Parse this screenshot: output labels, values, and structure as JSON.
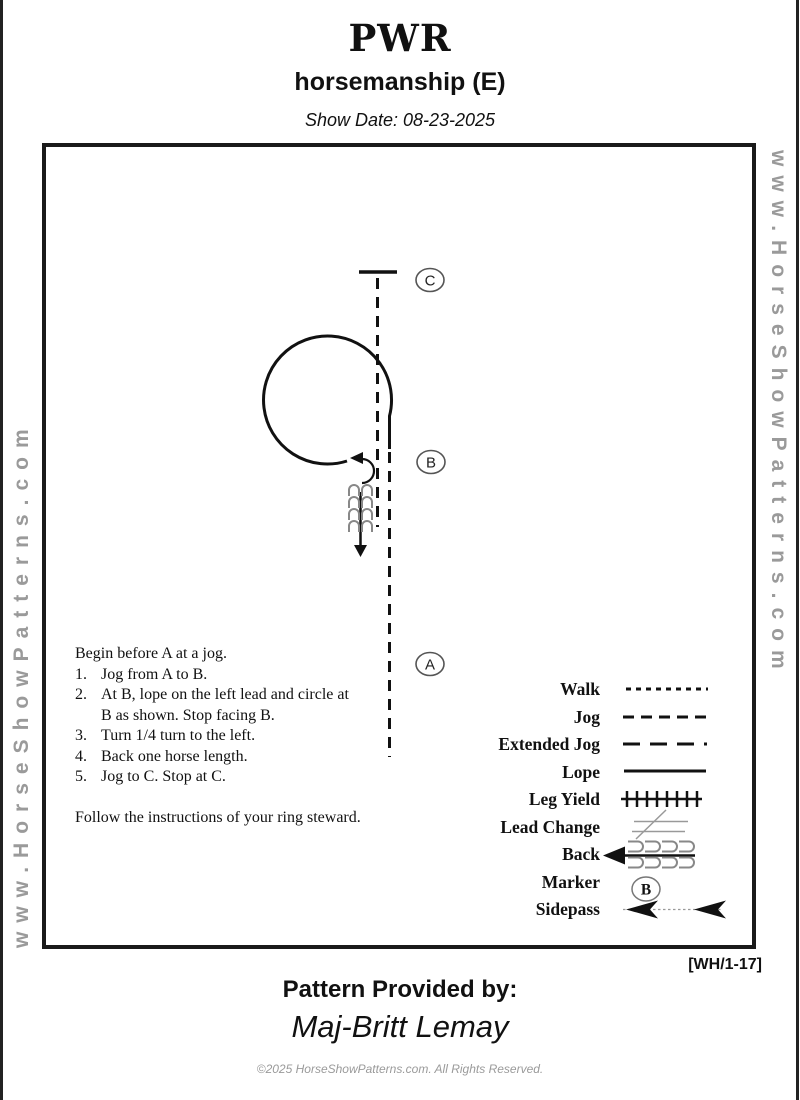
{
  "header": {
    "title": "PWR",
    "subtitle": "horsemanship (E)",
    "show_date": "Show Date: 08-23-2025"
  },
  "watermark": {
    "left": "www.HorseShowPatterns.com",
    "right": "www.HorseShowPatterns.com"
  },
  "pattern": {
    "markers": [
      {
        "label": "C"
      },
      {
        "label": "B"
      },
      {
        "label": "A"
      }
    ]
  },
  "instructions": {
    "intro": "Begin before A at a jog.",
    "steps": [
      {
        "num": "1.",
        "text": "Jog from A to B."
      },
      {
        "num": "2.",
        "text": "At B, lope on the left lead and circle at\nB as shown.  Stop facing B."
      },
      {
        "num": "3.",
        "text": "Turn 1/4 turn to the left."
      },
      {
        "num": "4.",
        "text": "Back one horse length."
      },
      {
        "num": "5.",
        "text": "Jog to C.  Stop at C."
      }
    ],
    "note": "Follow the instructions of  your ring steward."
  },
  "legend": {
    "items": [
      {
        "label": "Walk"
      },
      {
        "label": "Jog"
      },
      {
        "label": "Extended Jog"
      },
      {
        "label": "Lope"
      },
      {
        "label": "Leg Yield"
      },
      {
        "label": "Lead Change"
      },
      {
        "label": "Back"
      },
      {
        "label": "Marker",
        "symbol_letter": "B"
      },
      {
        "label": "Sidepass"
      }
    ]
  },
  "footer": {
    "code": "[WH/1-17]",
    "provided_by": "Pattern Provided by:",
    "provider": "Maj-Britt Lemay",
    "copyright": "©2025 HorseShowPatterns.com. All Rights Reserved."
  },
  "colors": {
    "ink": "#111111",
    "border": "#1a1a1a",
    "watermark_gray": "#9a9a9a",
    "symbol_gray": "#888888"
  }
}
